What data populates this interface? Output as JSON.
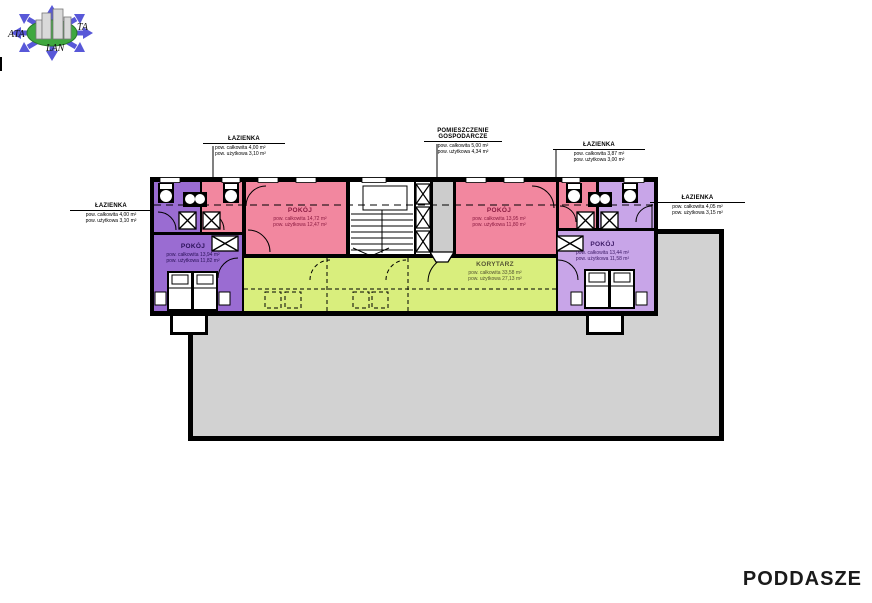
{
  "page": {
    "plan_title": "PODDASZE"
  },
  "logo": {
    "text_left": "ATA",
    "text_right": "TA",
    "text_bottom": "LAN"
  },
  "colors": {
    "wall": "#000000",
    "room_pink": "#f2879f",
    "room_purple": "#9a6cd2",
    "room_lilac": "#c8a5e8",
    "corridor_green": "#d9ee7d",
    "terrace_gray": "#d2d2d2",
    "utility_gray": "#cccccc",
    "arrow_blue": "#5858d8",
    "globe_green": "#3fa83f",
    "text_pink_room": "#8c1c42",
    "text_purple_room": "#2a1158",
    "text_lilac_room": "#3c1a66",
    "text_corridor": "#555533"
  },
  "plan": {
    "leader_labels": [
      {
        "title": "ŁAZIENKA",
        "area_total": "pow. całkowita 4,00 m²",
        "area_usable": "pow. użytkowa 3,10 m²"
      },
      {
        "title": "POMIESZCZENIE GOSPODARCZE",
        "area_total": "pow. całkowita 5,00 m²",
        "area_usable": "pow. użytkowa 4,34 m²"
      },
      {
        "title": "ŁAZIENKA",
        "area_total": "pow. całkowita 3,87 m²",
        "area_usable": "pow. użytkowa 3,00 m²"
      },
      {
        "title": "ŁAZIENKA",
        "area_total": "pow. całkowita 4,05 m²",
        "area_usable": "pow. użytkowa 3,15 m²"
      },
      {
        "title": "ŁAZIENKA",
        "area_total": "pow. całkowita 4,00 m²",
        "area_usable": "pow. użytkowa 3,10 m²"
      }
    ],
    "room_labels": [
      {
        "title": "POKÓJ",
        "area_total": "pow. całkowita 14,72 m²",
        "area_usable": "pow. użytkowa 12,47 m²"
      },
      {
        "title": "POKÓJ",
        "area_total": "pow. całkowita 13,95 m²",
        "area_usable": "pow. użytkowa 11,80 m²"
      },
      {
        "title": "POKÓJ",
        "area_total": "pow. całkowita 13,94 m²",
        "area_usable": "pow. użytkowa 11,82 m²"
      },
      {
        "title": "POKÓJ",
        "area_total": "pow. całkowita 13,44 m²",
        "area_usable": "pow. użytkowa 11,58 m²"
      },
      {
        "title": "KORYTARZ",
        "area_total": "pow. całkowita 33,58 m²",
        "area_usable": "pow. użytkowa 27,13 m²"
      }
    ]
  }
}
